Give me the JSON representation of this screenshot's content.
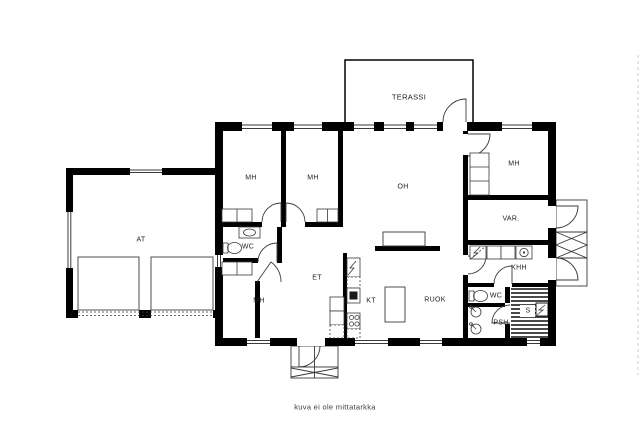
{
  "plan": {
    "rooms": {
      "terassi": "TERASSI",
      "mh_top_left": "MH",
      "mh_top_mid": "MH",
      "oh": "OH",
      "mh_top_right": "MH",
      "var": "VAR.",
      "at": "AT",
      "wc_left": "WC",
      "et": "ET",
      "mh_bottom_left": "MH",
      "kt": "KT",
      "ruok": "RUOK",
      "khh": "KHH",
      "wc_right": "WC",
      "sauna": "S",
      "psh": "PSH"
    },
    "footer_note": "kuva ei ole mittatarkka",
    "colors": {
      "wall": "#000000",
      "line": "#3a3a3a",
      "stripe": "#4a4a4a",
      "background": "#ffffff"
    }
  }
}
